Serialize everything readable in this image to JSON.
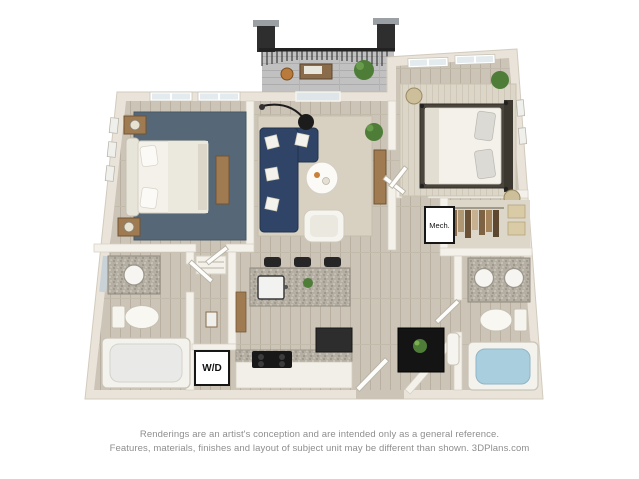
{
  "plan": {
    "labels": {
      "washer_dryer": "W/D",
      "mechanical": "Mech."
    },
    "colors": {
      "background": "#ffffff",
      "wall": "#e9e3d9",
      "wall_inner": "#f4f1ea",
      "floor_wood": "#cbc4b7",
      "bedroom1_rug": "#566877",
      "living_rug": "#d8d1c2",
      "sofa_navy": "#2f4466",
      "granite": "#b4aea3",
      "stool_black": "#262626",
      "wood_accent": "#a07a50",
      "tub_water": "#a9cede",
      "balcony_floor": "#c1c1c1",
      "railing_black": "#222222",
      "plant_green": "#4e7d38",
      "fixture_white": "#f6f4ee",
      "bed_frame_dark": "#4a453c"
    }
  },
  "footer": {
    "disclaimer_line1": "Renderings are an artist's conception and are intended only as a general reference.",
    "disclaimer_line2": "Features, materials, finishes and layout of subject unit may be different than shown. 3DPlans.com"
  }
}
